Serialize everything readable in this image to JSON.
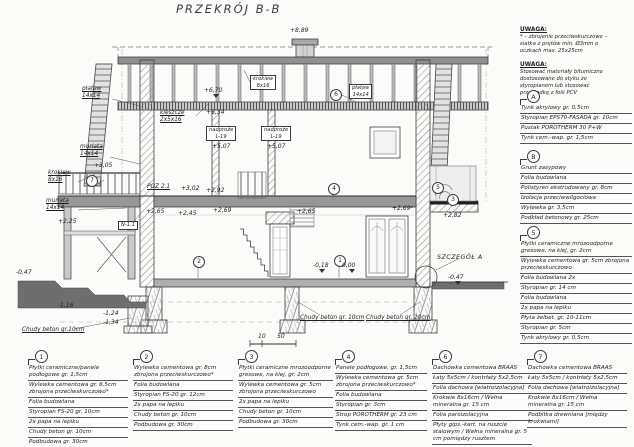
{
  "page": {
    "title": "PRZEKRÓJ B-B"
  },
  "notes": [
    {
      "heading": "UWAGA:",
      "body": "* – zbrojenie przeciwskurczowe –\nsiatka z prętów min. Ø3mm o\noczkach max. 25x25cm"
    },
    {
      "heading": "UWAGA:",
      "body": "Stosować materiały bitumiczne\ndostosowane do styku ze\nstyropianem lub stosować\nprzekładkę z folii PCV"
    }
  ],
  "legends": [
    {
      "id": "A",
      "x": 520,
      "y": 90,
      "w": 112,
      "lines": [
        "Tynk akrylowy gr. 0,5cm",
        "Styropian EPS70-FASADA gr. 10cm",
        "Pustak POROTHERM 30 P+W",
        "Tynk cem.-wap. gr. 1,5cm"
      ]
    },
    {
      "id": "B",
      "x": 520,
      "y": 150,
      "w": 112,
      "lines": [
        "Grunt zasypowy",
        "Folia budowlana",
        "Polistyren ekstrudowany gr. 8cm",
        "Izolacja przeciwwilgociowa",
        "Wylewka gr. 3,5cm",
        "Podkład betonowy gr. 25cm"
      ]
    },
    {
      "id": "5",
      "x": 520,
      "y": 226,
      "w": 112,
      "lines": [
        "Płytki ceramiczne mrozoodporne gresowe, na klej, gr. 2cm",
        "Wylewka cementowa gr. 5cm zbrojona przeciwskurczowo",
        "Folia budowlana 2x",
        "Styropian gr. 14 cm",
        "Folia budowlana",
        "2x papa na lepiku",
        "Płyta żelbet. gr. 10-11cm",
        "Styropian gr. 5cm",
        "Tynk akrylowy gr. 0,5cm"
      ]
    },
    {
      "id": "1",
      "x": 28,
      "y": 350,
      "w": 100,
      "lines": [
        "Płytki ceramiczne/panele podłogowe gr. 1,5cm",
        "Wylewka cementowa gr. 6,5cm zbrojona przeciwskurczowo*",
        "Folia budowlana",
        "Styropian FS-20 gr. 10cm",
        "2x papa na lepiku",
        "Chudy beton gr. 10cm",
        "Podbudowa gr. 30cm"
      ]
    },
    {
      "id": "2",
      "x": 133,
      "y": 350,
      "w": 100,
      "lines": [
        "Wylewka cementowa gr. 8cm zbrojona przeciwskurczowo*",
        "Folia budowlana",
        "Styropian FS-20 gr. 12cm",
        "2x papa na lepiku",
        "Chudy beton gr. 10cm",
        "Podbudowa gr. 30cm"
      ]
    },
    {
      "id": "3",
      "x": 238,
      "y": 350,
      "w": 95,
      "lines": [
        "Płytki ceramiczne mrozoodporne gresowe, na klej, gr. 2cm",
        "Wylewka cementowa gr. 5cm zbrojona przeciwskurczowo",
        "2x papa na lepiku",
        "Chudy beton gr. 10cm",
        "Podbudowa gr. 30cm"
      ]
    },
    {
      "id": "4",
      "x": 335,
      "y": 350,
      "w": 92,
      "lines": [
        "Panele podłogowe, gr. 1,5cm",
        "Wylewka cementowa gr. 5cm zbrojona przeciwskurczowo*",
        "Folia budowlana",
        "Styropian gr. 3cm",
        "Strop POROTHERM gr. 23 cm",
        "Tynk cem.-wap. gr. 1 cm"
      ]
    },
    {
      "id": "6",
      "x": 432,
      "y": 350,
      "w": 100,
      "lines": [
        "Dachówka cementowa BRAAS",
        "Łaty 5x5cm / kontrłaty 5x2,5cm",
        "Folia dachowa [wiatroizolacyjna]",
        "Krokwie 8x16cm / Wełna mineralna gr. 15 cm",
        "Folia paroizolacyjna",
        "Płyty gips.-kart. na ruszcie stalowym / Wełna mineralna gr. 5 cm pomiędzy rusztem"
      ]
    },
    {
      "id": "7",
      "x": 527,
      "y": 350,
      "w": 100,
      "lines": [
        "Dachówka cementowa BRAAS",
        "Łaty 5x5cm / kontrłaty 5x2,5cm",
        "Folia dachowa [wiatroizolacyjna]",
        "Krokwie 8x16cm / Wełna mineralna gr. 15 cm",
        "Podbitka drewniana [między krokwiami]"
      ]
    }
  ],
  "labels": [
    {
      "t": "+8,89",
      "x": 290,
      "y": 28,
      "s": "num",
      "n": "level-8-89"
    },
    {
      "t": "+6,70",
      "x": 204,
      "y": 88,
      "s": "num",
      "n": "level-6-70"
    },
    {
      "t": "+6,34",
      "x": 206,
      "y": 110,
      "s": "num",
      "n": "level-6-34"
    },
    {
      "t": "kleszcze\n2x5x16",
      "x": 160,
      "y": 110,
      "s": "nameu",
      "n": "label-kleszcze"
    },
    {
      "t": "krokiew\n8x16",
      "x": 250,
      "y": 75,
      "s": "box",
      "n": "label-krokiew-box"
    },
    {
      "t": "płatew\n14x14",
      "x": 349,
      "y": 84,
      "s": "box",
      "n": "label-platew-box"
    },
    {
      "t": "6",
      "x": 330,
      "y": 89,
      "s": "circ",
      "n": "ref-circle-6"
    },
    {
      "t": "płatew\n14x14",
      "x": 82,
      "y": 86,
      "s": "nameu",
      "n": "label-platew-left"
    },
    {
      "t": "murłata\n14x14",
      "x": 80,
      "y": 144,
      "s": "nameu",
      "n": "label-murlata-upper"
    },
    {
      "t": "+3,05",
      "x": 94,
      "y": 163,
      "s": "num",
      "n": "level-3-05"
    },
    {
      "t": "7",
      "x": 86,
      "y": 175,
      "s": "circ",
      "n": "ref-circle-7"
    },
    {
      "t": "krokiew\n8x16",
      "x": 48,
      "y": 170,
      "s": "nameu",
      "n": "label-krokiew-left"
    },
    {
      "t": "murłata\n14x14",
      "x": 46,
      "y": 198,
      "s": "nameu",
      "n": "label-murlata-lower"
    },
    {
      "t": "+2,25",
      "x": 58,
      "y": 219,
      "s": "num",
      "n": "level-2-25"
    },
    {
      "t": "nadproże\nL-19",
      "x": 206,
      "y": 126,
      "s": "box",
      "n": "label-nadproze-1"
    },
    {
      "t": "+5,07",
      "x": 212,
      "y": 144,
      "s": "num",
      "n": "level-5-07-a"
    },
    {
      "t": "nadproże\nL-19",
      "x": 261,
      "y": 126,
      "s": "box",
      "n": "label-nadproze-2"
    },
    {
      "t": "+5,07",
      "x": 267,
      "y": 144,
      "s": "num",
      "n": "level-5-07-b"
    },
    {
      "t": "POZ 2.1",
      "x": 147,
      "y": 184,
      "s": "nameu",
      "n": "label-poz-2-1"
    },
    {
      "t": "+3,02",
      "x": 181,
      "y": 186,
      "s": "num",
      "n": "level-3-02"
    },
    {
      "t": "+2,92",
      "x": 206,
      "y": 188,
      "s": "num",
      "n": "level-2-92"
    },
    {
      "t": "+2,65",
      "x": 146,
      "y": 209,
      "s": "num",
      "n": "level-2-65-left"
    },
    {
      "t": "+2,45",
      "x": 178,
      "y": 211,
      "s": "num",
      "n": "level-2-45"
    },
    {
      "t": "N-1.1",
      "x": 118,
      "y": 221,
      "s": "box",
      "n": "label-beam-n11"
    },
    {
      "t": "+2,69",
      "x": 213,
      "y": 208,
      "s": "num",
      "n": "level-2-69-mid"
    },
    {
      "t": "+2,65",
      "x": 297,
      "y": 209,
      "s": "num",
      "n": "level-2-65-mid"
    },
    {
      "t": "+2,69*",
      "x": 392,
      "y": 206,
      "s": "num",
      "n": "level-2-69-right"
    },
    {
      "t": "+2,82",
      "x": 443,
      "y": 213,
      "s": "num",
      "n": "level-2-82"
    },
    {
      "t": "5",
      "x": 432,
      "y": 182,
      "s": "circ",
      "n": "ref-circle-5"
    },
    {
      "t": "3",
      "x": 447,
      "y": 194,
      "s": "circ",
      "n": "ref-circle-3"
    },
    {
      "t": "4",
      "x": 328,
      "y": 183,
      "s": "circ",
      "n": "ref-circle-4"
    },
    {
      "t": "2",
      "x": 193,
      "y": 256,
      "s": "circ",
      "n": "ref-circle-2"
    },
    {
      "t": "1",
      "x": 334,
      "y": 255,
      "s": "circ",
      "n": "ref-circle-1"
    },
    {
      "t": "0,00",
      "x": 342,
      "y": 263,
      "s": "num",
      "n": "level-0-00"
    },
    {
      "t": "-0,18",
      "x": 313,
      "y": 263,
      "s": "num",
      "n": "level-m0-18"
    },
    {
      "t": "SZCZEGÓŁ A",
      "x": 437,
      "y": 254,
      "s": "cap",
      "n": "label-szczegol-a"
    },
    {
      "t": "-0,47",
      "x": 448,
      "y": 275,
      "s": "num",
      "n": "level-m0-47-right"
    },
    {
      "t": "-0,47",
      "x": 16,
      "y": 270,
      "s": "num",
      "n": "level-m0-47-left"
    },
    {
      "t": "-1,16",
      "x": 58,
      "y": 303,
      "s": "num",
      "n": "level-m1-16"
    },
    {
      "t": "-1,24",
      "x": 103,
      "y": 311,
      "s": "num",
      "n": "level-m1-24"
    },
    {
      "t": "-1,34",
      "x": 103,
      "y": 320,
      "s": "num",
      "n": "level-m1-34"
    },
    {
      "t": "Chudy beton gr.10cm",
      "x": 22,
      "y": 327,
      "s": "nameu",
      "n": "label-chudy-beton-left"
    },
    {
      "t": "Chudy beton gr. 10cm",
      "x": 300,
      "y": 315,
      "s": "nameu",
      "n": "label-chudy-beton-mid"
    },
    {
      "t": "Chudy beton gr. 10cm",
      "x": 366,
      "y": 315,
      "s": "nameu",
      "n": "label-chudy-beton-right"
    },
    {
      "t": "10",
      "x": 258,
      "y": 334,
      "s": "num",
      "n": "scale-tick-10"
    },
    {
      "t": "50",
      "x": 277,
      "y": 334,
      "s": "num",
      "n": "scale-tick-50"
    }
  ]
}
